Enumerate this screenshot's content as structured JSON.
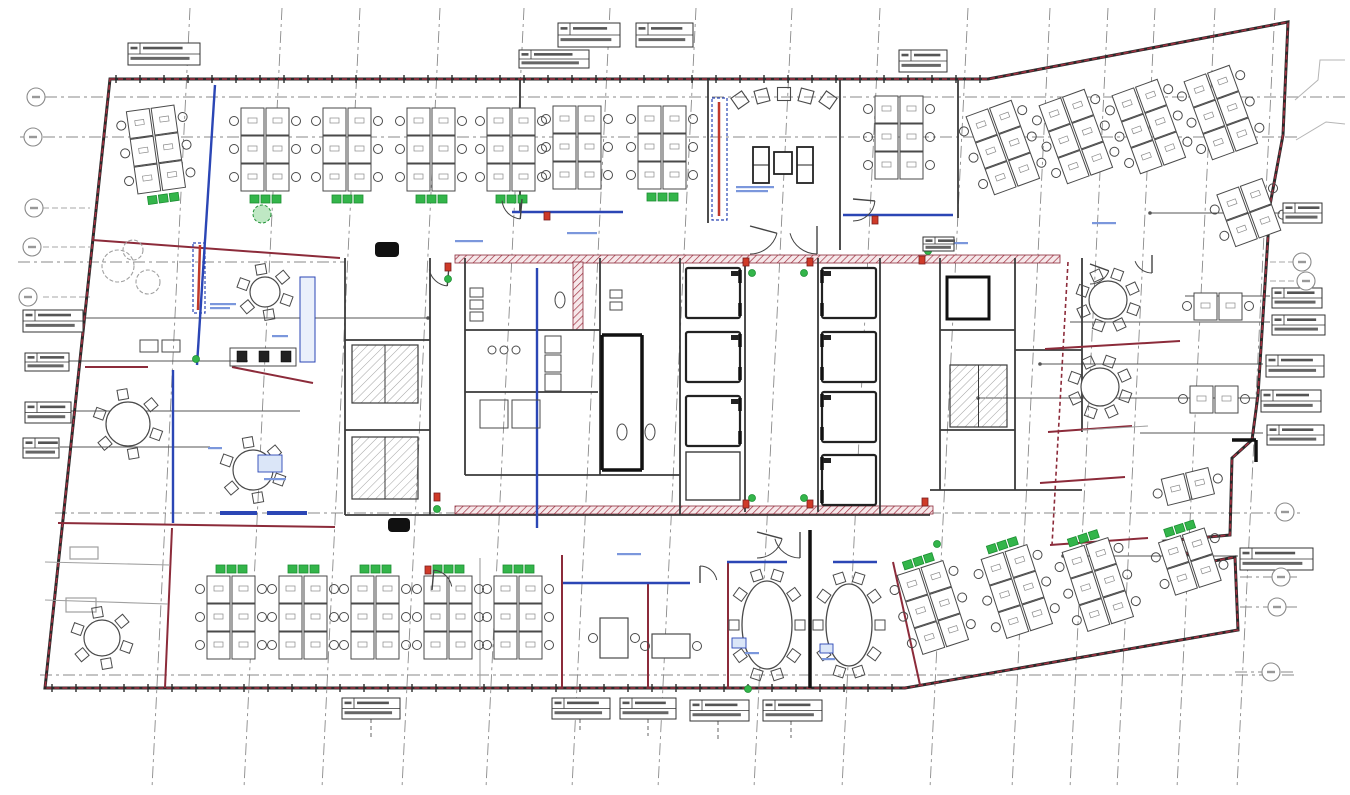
{
  "canvas": {
    "w": 1350,
    "h": 795,
    "bg": "#ffffff"
  },
  "colors": {
    "boundary_dark": "#2a2a2a",
    "boundary_red": "#a03040",
    "wall": "#3a3a3a",
    "wall_light": "#a0a0a0",
    "maroon": "#8c2b3a",
    "glass": "#2b46b5",
    "glass_light": "#7b97dc",
    "green": "#33b54a",
    "green_dark": "#1d8f33",
    "red_marker": "#cf3a28",
    "red_marker_dark": "#7a1f1f",
    "grid": "#8a8a8a",
    "furn": "#4a4a4a",
    "furn_light": "#8a8a8a",
    "hatch": "#999999",
    "band_bg": "#f6e8ea",
    "note": "#7b97dc",
    "black": "#111111",
    "leader": "#555555",
    "outside": "#b5b5b5"
  },
  "outline": {
    "points": [
      [
        110,
        79
      ],
      [
        988,
        79
      ],
      [
        1288,
        22
      ],
      [
        1283,
        135
      ],
      [
        1270,
        205
      ],
      [
        1258,
        395
      ],
      [
        1252,
        440
      ],
      [
        1232,
        458
      ],
      [
        1230,
        535
      ],
      [
        1166,
        541
      ],
      [
        1203,
        563
      ],
      [
        1235,
        557
      ],
      [
        1238,
        630
      ],
      [
        905,
        688
      ],
      [
        45,
        688
      ]
    ]
  },
  "wall_ticks": [
    {
      "y": 79,
      "x1": 116,
      "x2": 982,
      "step": 24
    },
    {
      "y": 688,
      "x1": 52,
      "x2": 900,
      "step": 24
    }
  ],
  "grid": {
    "verticals": [
      190,
      282,
      360,
      440,
      524,
      610,
      696,
      792,
      880,
      968,
      1050,
      1108,
      1155,
      1215,
      1275
    ],
    "vertical_lean": -38,
    "v_y1": 8,
    "v_y2": 788,
    "horizontals": [
      [
        97,
        45,
        1345
      ],
      [
        137,
        20,
        1300
      ],
      [
        262,
        18,
        345
      ],
      [
        513,
        55,
        1300
      ],
      [
        675,
        40,
        1295
      ],
      [
        577,
        1240,
        1297
      ],
      [
        607,
        1240,
        1297
      ],
      [
        672,
        1235,
        1297
      ]
    ],
    "bubble_stubs": [
      [
        208,
        43,
        90
      ],
      [
        247,
        43,
        90
      ],
      [
        297,
        43,
        90
      ],
      [
        262,
        1270,
        1295
      ],
      [
        281,
        1270,
        1298
      ]
    ],
    "bubbles": [
      [
        36,
        97
      ],
      [
        33,
        137
      ],
      [
        34,
        208
      ],
      [
        32,
        247
      ],
      [
        28,
        297
      ],
      [
        1302,
        262
      ],
      [
        1306,
        281
      ],
      [
        1285,
        512
      ],
      [
        1281,
        577
      ],
      [
        1277,
        607
      ],
      [
        1271,
        672
      ]
    ]
  },
  "leaders": [
    [
      318,
      85,
      428,
      1
    ],
    [
      361,
      68,
      248,
      0
    ],
    [
      411,
      70,
      300,
      0
    ],
    [
      447,
      60,
      210,
      0
    ],
    [
      213,
      1150,
      1280,
      1
    ],
    [
      296,
      1185,
      1270,
      0
    ],
    [
      322,
      1070,
      1270,
      0
    ],
    [
      364,
      1040,
      1263,
      1
    ],
    [
      398,
      978,
      1258,
      1
    ],
    [
      433,
      1140,
      1263,
      0
    ],
    [
      556,
      1063,
      1238,
      1
    ]
  ],
  "walls": {
    "dark": [
      [
        520,
        80,
        520,
        212
      ],
      [
        708,
        80,
        708,
        223
      ],
      [
        840,
        80,
        840,
        250
      ],
      [
        958,
        80,
        958,
        218
      ],
      [
        345,
        258,
        345,
        515
      ],
      [
        345,
        515,
        930,
        515
      ],
      [
        930,
        490,
        1082,
        490
      ],
      [
        1082,
        258,
        1082,
        432
      ],
      [
        430,
        258,
        430,
        515
      ],
      [
        465,
        258,
        465,
        475
      ],
      [
        600,
        258,
        600,
        475
      ],
      [
        680,
        258,
        680,
        515
      ],
      [
        745,
        258,
        745,
        512
      ],
      [
        818,
        258,
        818,
        512
      ],
      [
        880,
        258,
        880,
        515
      ],
      [
        940,
        258,
        940,
        490
      ],
      [
        1015,
        258,
        1015,
        490
      ],
      [
        465,
        330,
        600,
        330
      ],
      [
        465,
        392,
        598,
        392
      ],
      [
        465,
        475,
        680,
        475
      ],
      [
        940,
        330,
        1015,
        330
      ],
      [
        940,
        430,
        1015,
        430
      ],
      [
        1015,
        350,
        1082,
        350
      ],
      [
        345,
        340,
        430,
        340
      ],
      [
        345,
        430,
        430,
        430
      ]
    ],
    "dark_thick": [
      [
        602,
        335,
        602,
        470
      ],
      [
        642,
        335,
        642,
        470
      ],
      [
        602,
        335,
        642,
        335
      ],
      [
        602,
        470,
        642,
        470
      ],
      [
        810,
        530,
        810,
        688
      ],
      [
        1232,
        440,
        1256,
        440
      ],
      [
        1256,
        440,
        1256,
        462
      ]
    ],
    "maroon": [
      [
        85,
        367,
        148,
        367
      ],
      [
        232,
        367,
        313,
        383
      ],
      [
        58,
        523,
        335,
        527
      ],
      [
        92,
        240,
        340,
        258
      ],
      [
        562,
        555,
        562,
        688
      ],
      [
        648,
        583,
        648,
        688
      ],
      [
        728,
        562,
        728,
        688
      ],
      [
        893,
        562,
        920,
        685
      ],
      [
        172,
        528,
        165,
        688
      ],
      [
        1045,
        349,
        1180,
        341
      ],
      [
        1048,
        432,
        1132,
        426
      ],
      [
        1040,
        483,
        1125,
        477
      ],
      [
        1050,
        545,
        1148,
        538
      ]
    ],
    "maroon_dashed": [
      [
        1068,
        262,
        1052,
        545
      ]
    ],
    "glass": [
      [
        512,
        212,
        623,
        212
      ],
      [
        843,
        215,
        953,
        215
      ],
      [
        563,
        583,
        690,
        583
      ],
      [
        727,
        562,
        787,
        562
      ],
      [
        833,
        562,
        877,
        562
      ],
      [
        215,
        85,
        197,
        365
      ],
      [
        537,
        268,
        537,
        528
      ],
      [
        173,
        370,
        173,
        523
      ]
    ],
    "glass_heavy": [
      [
        220,
        513,
        257,
        513
      ],
      [
        267,
        513,
        307,
        513
      ]
    ],
    "light": [
      [
        480,
        558,
        480,
        688
      ],
      [
        45,
        562,
        170,
        565
      ],
      [
        45,
        600,
        168,
        604
      ],
      [
        1082,
        430,
        1148,
        426
      ]
    ]
  },
  "strips": [
    {
      "rect": [
        712,
        98,
        15,
        122
      ],
      "line": [
        719,
        102,
        719,
        216
      ]
    },
    {
      "rect": [
        193,
        243,
        12,
        70
      ],
      "line": [
        200,
        245,
        198,
        310
      ]
    }
  ],
  "counter_blue": [
    300,
    277,
    15,
    85
  ],
  "fire_bands": [
    [
      455,
      255,
      605,
      8
    ],
    [
      455,
      506,
      478,
      8
    ],
    [
      573,
      262,
      10,
      68
    ]
  ],
  "stairs": [
    [
      352,
      345,
      66,
      58
    ],
    [
      352,
      437,
      66,
      62
    ],
    [
      950,
      365,
      57,
      62
    ]
  ],
  "elevators": {
    "w": 54,
    "h": 50,
    "door_right": [
      [
        686,
        268
      ],
      [
        686,
        332
      ],
      [
        686,
        396
      ]
    ],
    "door_left": [
      [
        822,
        268
      ],
      [
        822,
        332
      ],
      [
        822,
        392
      ],
      [
        822,
        455
      ]
    ],
    "plain": [
      686,
      452,
      54,
      48
    ],
    "single": [
      947,
      277,
      42,
      42
    ]
  },
  "benches": [
    [
      156,
      150,
      -8,
      3,
      "bottom"
    ],
    [
      265,
      150,
      0,
      3,
      "bottom"
    ],
    [
      347,
      150,
      0,
      3,
      "bottom"
    ],
    [
      431,
      150,
      0,
      3,
      "bottom"
    ],
    [
      511,
      150,
      0,
      3,
      "bottom"
    ],
    [
      577,
      148,
      0,
      3,
      null
    ],
    [
      662,
      148,
      0,
      3,
      "bottom"
    ],
    [
      899,
      138,
      0,
      3,
      null
    ],
    [
      1003,
      148,
      -20,
      3,
      null
    ],
    [
      1076,
      137,
      -20,
      3,
      null
    ],
    [
      1149,
      127,
      -20,
      3,
      null
    ],
    [
      1221,
      113,
      -20,
      3,
      null
    ],
    [
      1249,
      213,
      -20,
      2,
      null
    ],
    [
      231,
      618,
      0,
      3,
      "top"
    ],
    [
      303,
      618,
      0,
      3,
      "top"
    ],
    [
      375,
      618,
      0,
      3,
      "top"
    ],
    [
      448,
      618,
      0,
      3,
      "top"
    ],
    [
      518,
      618,
      0,
      3,
      "top"
    ],
    [
      933,
      608,
      -18,
      3,
      "top"
    ],
    [
      1017,
      592,
      -18,
      3,
      "top"
    ],
    [
      1098,
      585,
      -18,
      3,
      "top"
    ],
    [
      1190,
      562,
      -18,
      2,
      "top"
    ],
    [
      1218,
      307,
      0,
      1,
      null
    ],
    [
      1214,
      400,
      0,
      1,
      null
    ],
    [
      1188,
      487,
      -14,
      1,
      null
    ]
  ],
  "round_tables": [
    [
      265,
      292,
      15,
      6
    ],
    [
      128,
      424,
      22,
      6
    ],
    [
      253,
      470,
      20,
      6
    ],
    [
      102,
      638,
      18,
      6
    ],
    [
      1108,
      300,
      19,
      8
    ],
    [
      1100,
      387,
      19,
      8
    ]
  ],
  "oval_tables": [
    [
      767,
      625,
      25,
      44,
      10
    ],
    [
      849,
      625,
      23,
      41,
      10
    ]
  ],
  "rect_tables": [
    [
      600,
      618,
      28,
      40
    ],
    [
      652,
      634,
      38,
      24
    ]
  ],
  "sofa_set": {
    "left": [
      753,
      147,
      16,
      36
    ],
    "right": [
      797,
      147,
      16,
      36
    ],
    "table": [
      774,
      152,
      18,
      22
    ]
  },
  "lounge_chairs": [
    [
      740,
      100,
      -35
    ],
    [
      762,
      96,
      -15
    ],
    [
      784,
      94,
      0
    ],
    [
      806,
      96,
      15
    ],
    [
      828,
      100,
      35
    ]
  ],
  "copy_area": {
    "light": [
      [
        140,
        340,
        18,
        12
      ],
      [
        162,
        340,
        18,
        12
      ],
      [
        230,
        348,
        66,
        18
      ]
    ],
    "dark": [
      [
        237,
        351,
        10,
        11
      ],
      [
        259,
        351,
        10,
        11
      ],
      [
        281,
        351,
        10,
        11
      ]
    ]
  },
  "balconies": [
    [
      70,
      547,
      28,
      12
    ],
    [
      66,
      598,
      30,
      14
    ]
  ],
  "plants_gray": [
    [
      118,
      266,
      16
    ],
    [
      148,
      282,
      12
    ],
    [
      133,
      250,
      10
    ]
  ],
  "plant_green": [
    262,
    214,
    9
  ],
  "black_blobs": [
    [
      375,
      242,
      24,
      15
    ],
    [
      388,
      518,
      22,
      14
    ]
  ],
  "wc": {
    "rects": [
      [
        470,
        288,
        13,
        9
      ],
      [
        470,
        300,
        13,
        9
      ],
      [
        470,
        312,
        13,
        9
      ],
      [
        545,
        336,
        16,
        17
      ],
      [
        545,
        355,
        16,
        17
      ],
      [
        545,
        374,
        16,
        17
      ],
      [
        480,
        400,
        28,
        28
      ],
      [
        512,
        400,
        28,
        28
      ],
      [
        610,
        290,
        12,
        8
      ],
      [
        610,
        302,
        12,
        8
      ]
    ],
    "circles": [
      [
        492,
        350,
        4
      ],
      [
        504,
        350,
        4
      ],
      [
        516,
        350,
        4
      ]
    ],
    "pans": [
      [
        622,
        432,
        5,
        8
      ],
      [
        650,
        432,
        5,
        8
      ],
      [
        560,
        300,
        5,
        8
      ]
    ]
  },
  "door_arcs": [
    [
      750,
      226,
      28,
      15,
      90
    ],
    [
      817,
      226,
      28,
      90,
      165
    ],
    [
      853,
      199,
      22,
      5,
      90
    ],
    [
      449,
      266,
      20,
      95,
      170
    ],
    [
      700,
      583,
      17,
      270,
      350
    ],
    [
      757,
      532,
      26,
      15,
      90
    ],
    [
      800,
      532,
      26,
      90,
      165
    ],
    [
      1090,
      264,
      20,
      20,
      90
    ],
    [
      1152,
      255,
      18,
      90,
      160
    ],
    [
      432,
      590,
      20,
      275,
      350
    ],
    [
      522,
      199,
      20,
      95,
      175
    ]
  ],
  "markers_red": [
    [
      448,
      267
    ],
    [
      437,
      497
    ],
    [
      746,
      262
    ],
    [
      810,
      262
    ],
    [
      746,
      504
    ],
    [
      810,
      504
    ],
    [
      922,
      260
    ],
    [
      925,
      502
    ],
    [
      875,
      220
    ],
    [
      547,
      216
    ],
    [
      428,
      570
    ]
  ],
  "markers_green": [
    [
      448,
      279
    ],
    [
      437,
      509
    ],
    [
      752,
      273
    ],
    [
      804,
      273
    ],
    [
      752,
      498
    ],
    [
      804,
      498
    ],
    [
      928,
      251
    ],
    [
      196,
      359
    ],
    [
      748,
      689
    ],
    [
      937,
      544
    ]
  ],
  "notes": [
    [
      736,
      186,
      38,
      2
    ],
    [
      567,
      232,
      30,
      1
    ],
    [
      455,
      240,
      28,
      1
    ],
    [
      938,
      242,
      30,
      1
    ],
    [
      210,
      303,
      26,
      2
    ],
    [
      272,
      335,
      16,
      1
    ],
    [
      208,
      447,
      14,
      1
    ],
    [
      617,
      553,
      24,
      1
    ],
    [
      1092,
      222,
      24,
      1
    ],
    [
      745,
      652,
      14,
      1
    ],
    [
      822,
      658,
      13,
      1
    ],
    [
      264,
      478,
      22,
      1
    ]
  ],
  "blue_rects": [
    [
      732,
      638,
      14,
      10
    ],
    [
      820,
      644,
      13,
      9
    ],
    [
      258,
      455,
      24,
      17
    ]
  ],
  "tags": [
    [
      128,
      43,
      72,
      22
    ],
    [
      519,
      50,
      70,
      18
    ],
    [
      558,
      23,
      62,
      24
    ],
    [
      636,
      23,
      57,
      24
    ],
    [
      899,
      50,
      48,
      22
    ],
    [
      1283,
      203,
      39,
      20
    ],
    [
      1272,
      288,
      50,
      20
    ],
    [
      1272,
      315,
      53,
      20
    ],
    [
      1266,
      355,
      58,
      22
    ],
    [
      1261,
      390,
      60,
      22
    ],
    [
      1267,
      425,
      57,
      20
    ],
    [
      1240,
      548,
      73,
      22
    ],
    [
      23,
      310,
      60,
      22
    ],
    [
      25,
      353,
      44,
      18
    ],
    [
      25,
      402,
      46,
      21
    ],
    [
      23,
      438,
      36,
      20
    ],
    [
      342,
      698,
      58,
      21
    ],
    [
      552,
      698,
      58,
      21
    ],
    [
      620,
      698,
      56,
      21
    ],
    [
      690,
      700,
      59,
      21
    ],
    [
      763,
      700,
      59,
      21
    ],
    [
      923,
      237,
      31,
      14
    ]
  ],
  "tag_stubs": [
    [
      371,
      719,
      738
    ],
    [
      580,
      719,
      733
    ],
    [
      648,
      719,
      736
    ],
    [
      718,
      721,
      740
    ],
    [
      791,
      721,
      738
    ]
  ],
  "outside_lines": [
    [
      [
        1295,
        100
      ],
      [
        1318,
        80
      ],
      [
        1320,
        60
      ],
      [
        1345,
        60
      ]
    ],
    [
      [
        1296,
        140
      ],
      [
        1326,
        122
      ],
      [
        1345,
        124
      ]
    ]
  ]
}
